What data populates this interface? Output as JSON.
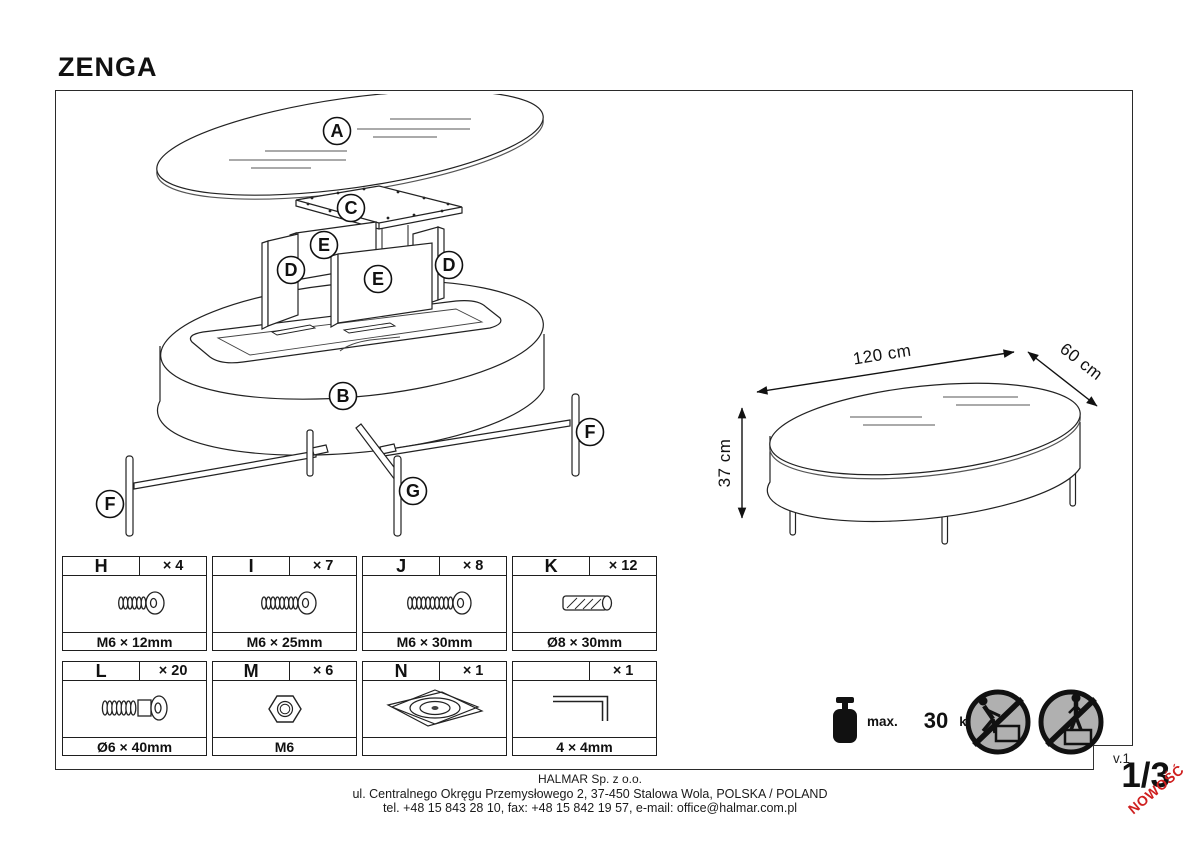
{
  "page": {
    "title": "ZENGA",
    "version": "v.1",
    "page_number": "1/3",
    "new_badge": "NOWOŚĆ"
  },
  "exploded": {
    "labels": {
      "A": "A",
      "B": "B",
      "C": "C",
      "D": "D",
      "E": "E",
      "F": "F",
      "G": "G"
    }
  },
  "dimensions": {
    "length": "120 cm",
    "depth": "60 cm",
    "height": "37 cm"
  },
  "hardware": {
    "items": [
      {
        "letter": "H",
        "count": "× 4",
        "size": "M6 × 12mm",
        "icon": "hex-socket-bolt-short"
      },
      {
        "letter": "I",
        "count": "× 7",
        "size": "M6 × 25mm",
        "icon": "hex-socket-bolt-medium"
      },
      {
        "letter": "J",
        "count": "× 8",
        "size": "M6 × 30mm",
        "icon": "hex-socket-bolt-long"
      },
      {
        "letter": "K",
        "count": "× 12",
        "size": "Ø8 × 30mm",
        "icon": "wooden-dowel"
      },
      {
        "letter": "L",
        "count": "× 20",
        "size": "Ø6 × 40mm",
        "icon": "connector-screw"
      },
      {
        "letter": "M",
        "count": "× 6",
        "size": "M6",
        "icon": "hex-nut"
      },
      {
        "letter": "N",
        "count": "× 1",
        "size": "",
        "icon": "swivel-plate"
      },
      {
        "letter": "",
        "count": "× 1",
        "size": "4 × 4mm",
        "icon": "allen-key"
      }
    ]
  },
  "load_limit": {
    "prefix": "max.",
    "value": "30",
    "unit": "kg"
  },
  "footer": {
    "company": "HALMAR Sp. z o.o.",
    "address": "ul. Centralnego Okręgu Przemysłowego 2, 37-450 Stalowa Wola, POLSKA / POLAND",
    "contact": "tel. +48 15 843 28 10, fax: +48 15 842 19 57, e-mail: office@halmar.com.pl"
  }
}
